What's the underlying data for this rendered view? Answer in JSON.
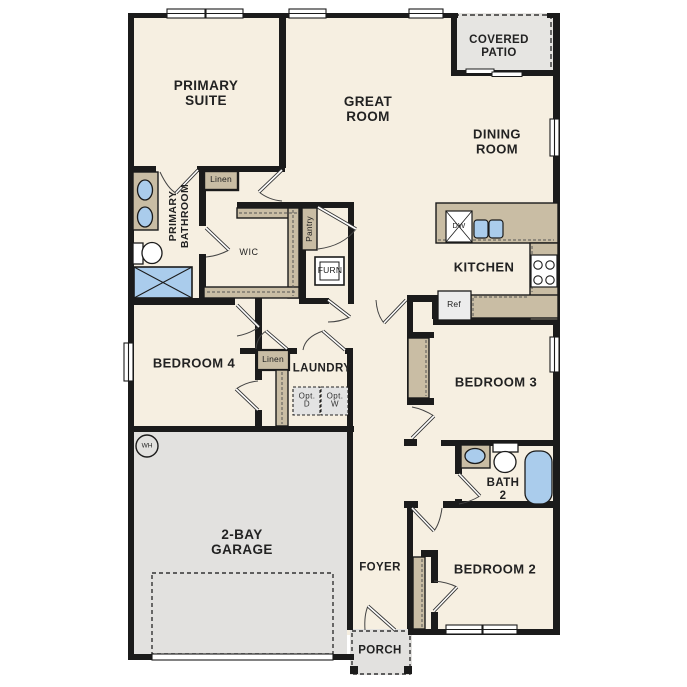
{
  "rooms": {
    "primary_suite": "PRIMARY\nSUITE",
    "great_room": "GREAT\nROOM",
    "covered_patio": "COVERED\nPATIO",
    "dining_room": "DINING\nROOM",
    "kitchen": "KITCHEN",
    "primary_bathroom": "PRIMARY\nBATHROOM",
    "wic": "WIC",
    "bedroom4": "BEDROOM 4",
    "laundry": "LAUNDRY",
    "bedroom3": "BEDROOM 3",
    "bath2": "BATH\n2",
    "bedroom2": "BEDROOM 2",
    "foyer": "FOYER",
    "garage": "2-BAY\nGARAGE",
    "porch": "PORCH"
  },
  "closets": {
    "linen_upper": "Linen",
    "linen_hall": "Linen",
    "pantry": "Pantry"
  },
  "appliances": {
    "dishwasher": "DW",
    "refrigerator": "Ref",
    "furnace": "FURN",
    "water_heater": "WH",
    "optional_dryer": "Opt.\nD",
    "optional_washer": "Opt.\nW"
  },
  "colors": {
    "wall": "#1b1b1b",
    "floor": "#f6efe1",
    "cabinet_tan": "#c9bda4",
    "garage_gray": "#e2e1df",
    "fixture_blue": "#aaccec",
    "patio_gray": "#e6e5e2"
  }
}
